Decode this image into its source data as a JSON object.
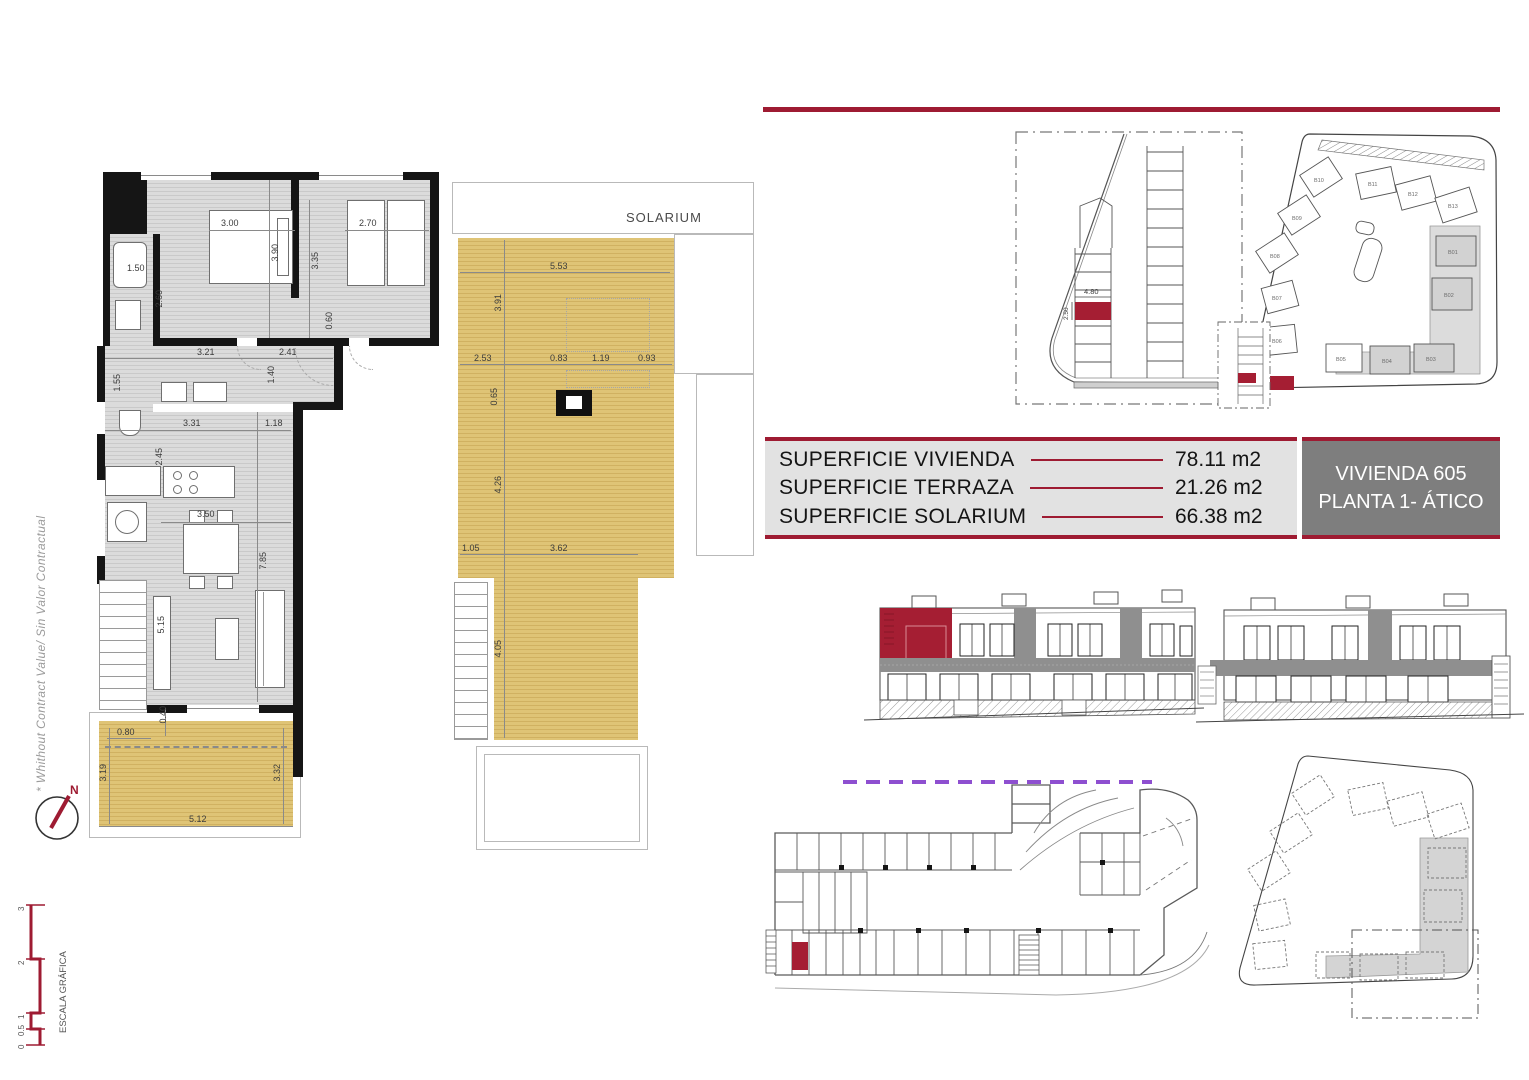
{
  "colors": {
    "accent": "#9e1b32",
    "tan": "#d8bc6d",
    "purple": "#8e4fd0",
    "floor_gray": "#d9d9d9"
  },
  "side_note": "* Whithout Contract Value/ Sin Valor Contractual",
  "north_label": "N",
  "scale_bar": {
    "title": "ESCALA GRÁFICA",
    "ticks": [
      "0",
      "0.5",
      "1",
      "2",
      "3"
    ]
  },
  "floor_plan": {
    "dims": {
      "bed1_w": "3.00",
      "bed1_h": "3.90",
      "bed2_w": "2.70",
      "bed2_h": "3.35",
      "bath_w": "1.50",
      "bath_h": "2.60",
      "wall_gap": "0.60",
      "hall_a": "3.21",
      "hall_b": "2.41",
      "hall_h": "1.40",
      "wc_h": "1.55",
      "kitchen_w": "3.31",
      "pass_w": "1.18",
      "kitchen_h": "2.45",
      "living_w": "3.50",
      "living_h": "7.85",
      "salon_l": "5.15",
      "terrace_a": "0.80",
      "terrace_b": "0.40",
      "terrace_h1": "3.19",
      "terrace_h2": "3.32",
      "terrace_w": "5.12"
    }
  },
  "solarium_plan": {
    "title": "SOLARIUM",
    "dims": {
      "top_w": "5.53",
      "top_h": "3.91",
      "seg_a": "2.53",
      "seg_b": "0.83",
      "seg_c": "1.19",
      "seg_d": "0.93",
      "chim_h": "0.65",
      "mid_h": "4.26",
      "bot_a": "1.05",
      "bot_b": "3.62",
      "bot_h": "4.05"
    }
  },
  "parking_plan": {
    "space_width": "4.80",
    "space_depth": "2.50"
  },
  "site_plan": {
    "buildings": {
      "b01": "B01",
      "b02": "B02",
      "b03": "B03",
      "b04": "B04",
      "b05": "B05",
      "b06": "B06",
      "b07": "B07",
      "b08": "B08",
      "b09": "B09",
      "b10": "B10",
      "b11": "B11",
      "b12": "B12",
      "b13": "B13"
    }
  },
  "summary": {
    "rows": [
      {
        "label": "SUPERFICIE VIVIENDA",
        "value": "78.11 m2"
      },
      {
        "label": "SUPERFICIE TERRAZA",
        "value": "21.26 m2"
      },
      {
        "label": "SUPERFICIE SOLARIUM",
        "value": "66.38 m2"
      }
    ]
  },
  "unit_box": {
    "line1": "VIVIENDA 605",
    "line2": "PLANTA 1- ÁTICO"
  }
}
